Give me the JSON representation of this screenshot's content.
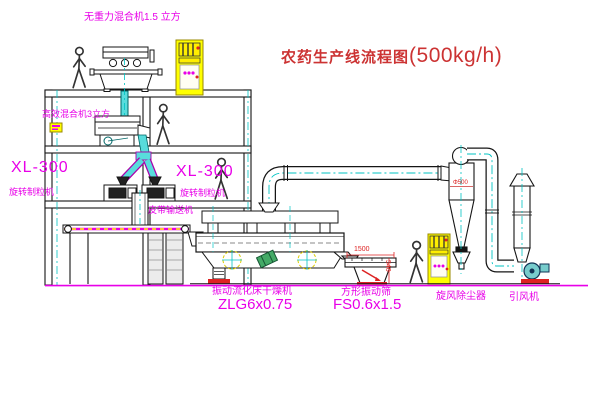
{
  "title": {
    "name": "农药生产线流程图",
    "capacity": "(500kg/h)"
  },
  "equipment_labels": {
    "gravity_free_mixer": "无重力混合机1.5 立方",
    "high_efficiency_mixer": "高效混合机3立方",
    "granulator_left_model": "XL-300",
    "granulator_left_name": "旋转制粒机",
    "granulator_right_model": "XL-300",
    "granulator_right_name": "旋转制粒机",
    "belt_conveyor": "皮带输送机",
    "fluid_bed_dryer_name": "振动流化床干燥机",
    "fluid_bed_dryer_model": "ZLG6x0.75",
    "vibrating_screen_name": "方形振动筛",
    "vibrating_screen_model": "FS0.6x1.5",
    "cyclone_dust_collector": "旋风除尘器",
    "induced_draft_fan": "引风机"
  },
  "dimension_annotations": {
    "screen_length": "1500",
    "screen_height": "540",
    "cyclone_diameter": "Φ500"
  },
  "colors": {
    "label_magenta": "#e800e8",
    "title_red": "#cc3333",
    "dimension_red": "#dd2222",
    "centerline_cyan": "#00c3c3",
    "pipe_cyan": "#58dcdc",
    "cabinet_yellow": "#ffff00",
    "motor_green": "#44aa66",
    "ground_magenta": "#e800e8"
  }
}
